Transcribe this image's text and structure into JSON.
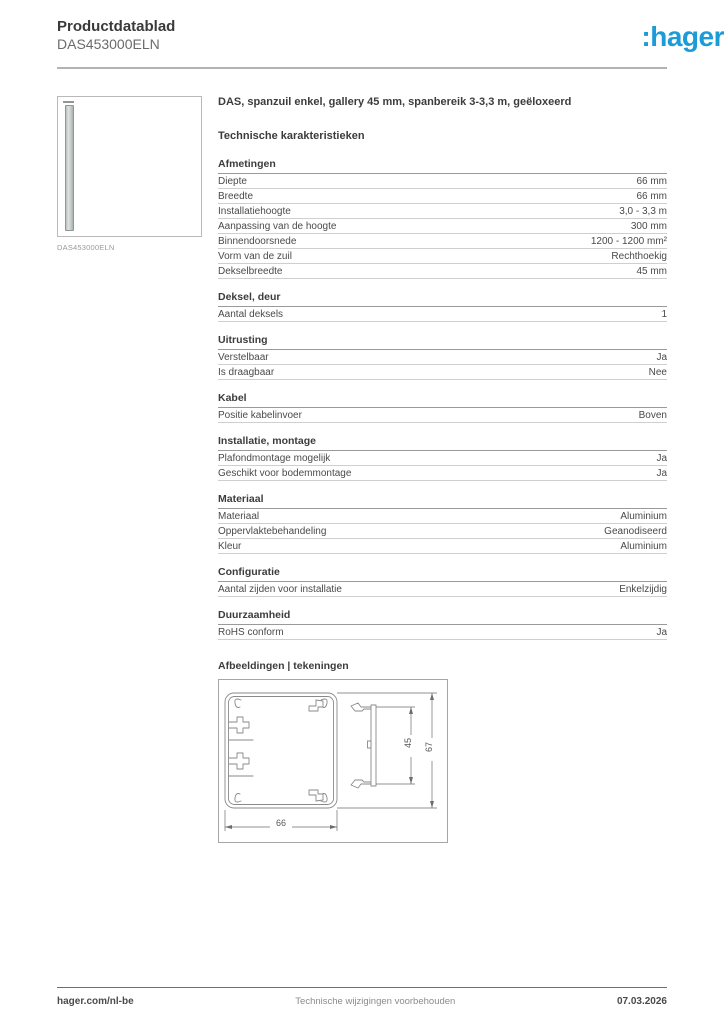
{
  "header": {
    "title": "Productdatablad",
    "subtitle": "DAS453000ELN"
  },
  "logo": {
    "prefix": ":",
    "text": "hager",
    "color": "#1b9cd8"
  },
  "product_image": {
    "caption": "DAS453000ELN"
  },
  "main": {
    "product_title": "DAS, spanzuil enkel, gallery 45 mm, spanbereik 3-3,3 m, geëloxeerd",
    "section_title": "Technische karakteristieken",
    "groups": [
      {
        "title": "Afmetingen",
        "rows": [
          {
            "label": "Diepte",
            "value": "66 mm"
          },
          {
            "label": "Breedte",
            "value": "66 mm"
          },
          {
            "label": "Installatiehoogte",
            "value": "3,0 - 3,3 m"
          },
          {
            "label": "Aanpassing van de hoogte",
            "value": "300 mm"
          },
          {
            "label": "Binnendoorsnede",
            "value": "1200 - 1200 mm²"
          },
          {
            "label": "Vorm van de zuil",
            "value": "Rechthoekig"
          },
          {
            "label": "Dekselbreedte",
            "value": "45 mm"
          }
        ]
      },
      {
        "title": "Deksel, deur",
        "rows": [
          {
            "label": "Aantal deksels",
            "value": "1"
          }
        ]
      },
      {
        "title": "Uitrusting",
        "rows": [
          {
            "label": "Verstelbaar",
            "value": "Ja"
          },
          {
            "label": "Is draagbaar",
            "value": "Nee"
          }
        ]
      },
      {
        "title": "Kabel",
        "rows": [
          {
            "label": "Positie kabelinvoer",
            "value": "Boven"
          }
        ]
      },
      {
        "title": "Installatie, montage",
        "rows": [
          {
            "label": "Plafondmontage mogelijk",
            "value": "Ja"
          },
          {
            "label": "Geschikt voor bodemmontage",
            "value": "Ja"
          }
        ]
      },
      {
        "title": "Materiaal",
        "rows": [
          {
            "label": "Materiaal",
            "value": "Aluminium"
          },
          {
            "label": "Oppervlaktebehandeling",
            "value": "Geanodiseerd"
          },
          {
            "label": "Kleur",
            "value": "Aluminium"
          }
        ]
      },
      {
        "title": "Configuratie",
        "rows": [
          {
            "label": "Aantal zijden voor installatie",
            "value": "Enkelzijdig"
          }
        ]
      },
      {
        "title": "Duurzaamheid",
        "rows": [
          {
            "label": "RoHS conform",
            "value": "Ja"
          }
        ]
      }
    ],
    "drawings_title": "Afbeeldingen | tekeningen",
    "drawing": {
      "width_label": "66",
      "cover_label": "45",
      "height_label": "67"
    }
  },
  "footer": {
    "left": "hager.com/nl-be",
    "center": "Technische wijzigingen voorbehouden",
    "right": "07.03.2026"
  }
}
